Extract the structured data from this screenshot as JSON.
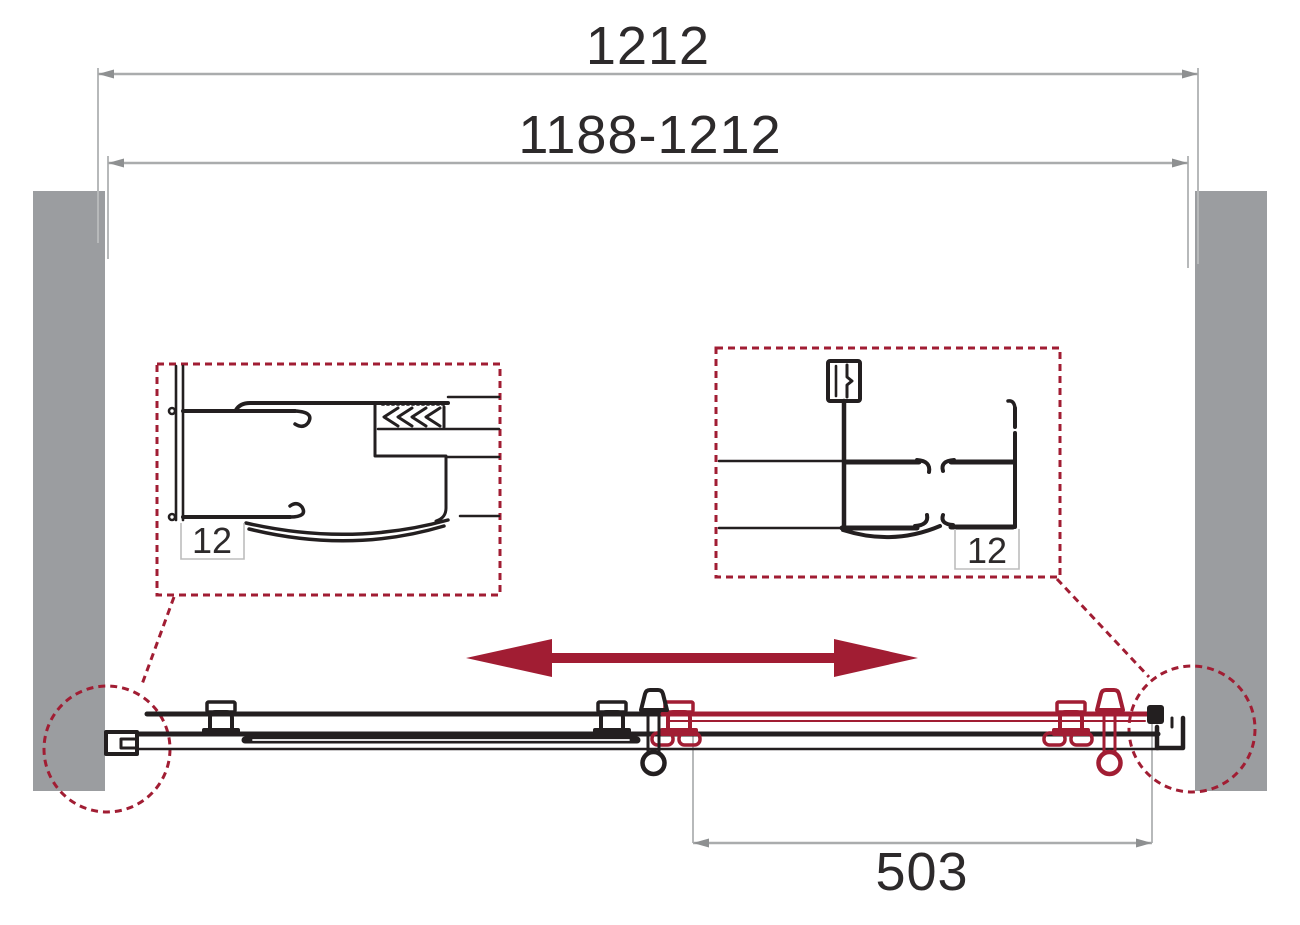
{
  "page": {
    "kind": "technical-drawing",
    "view": "plan view of sliding shower door in niche",
    "background": "#ffffff"
  },
  "colors": {
    "accent_red": "#A11D33",
    "line_black": "#231F20",
    "wall_gray": "#9B9DA0",
    "dim_line_gray": "#AAACAD",
    "dim_ext_gray": "#B7B9BA",
    "dim_box_gray": "#BDBDBD",
    "text_dark": "#2D2A2B"
  },
  "dimensions": {
    "overall_width": {
      "label": "1212"
    },
    "adjustment_range": {
      "label": "1188-1212"
    },
    "door_panel_width": {
      "label": "503"
    },
    "glass_thickness_left": {
      "label": "12"
    },
    "glass_thickness_right": {
      "label": "12"
    }
  },
  "icons": [
    "slide-direction-arrow-icon",
    "magnifier-circle-left",
    "magnifier-circle-right",
    "wall-hatch-left",
    "wall-hatch-right"
  ]
}
